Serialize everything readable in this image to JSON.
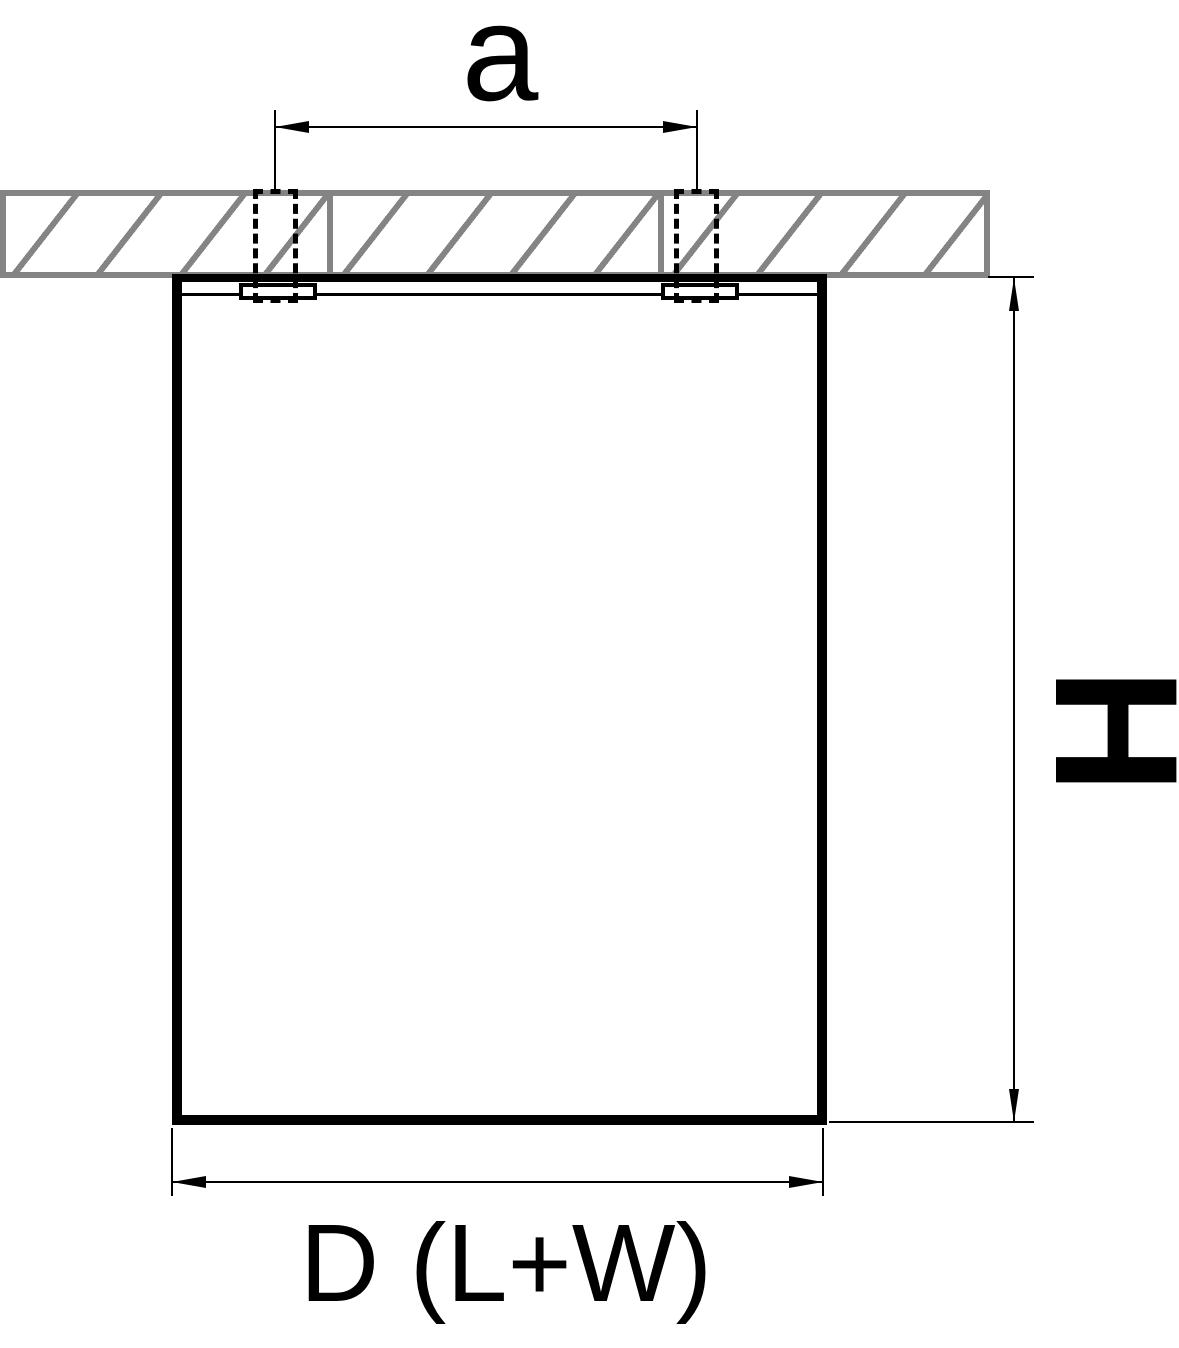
{
  "diagram": {
    "labels": {
      "spacing": "a",
      "height": "H",
      "diameter": "D (L+W)"
    },
    "colors": {
      "line": "#000000",
      "ceiling_gray": "#848484",
      "background": "#ffffff"
    }
  }
}
